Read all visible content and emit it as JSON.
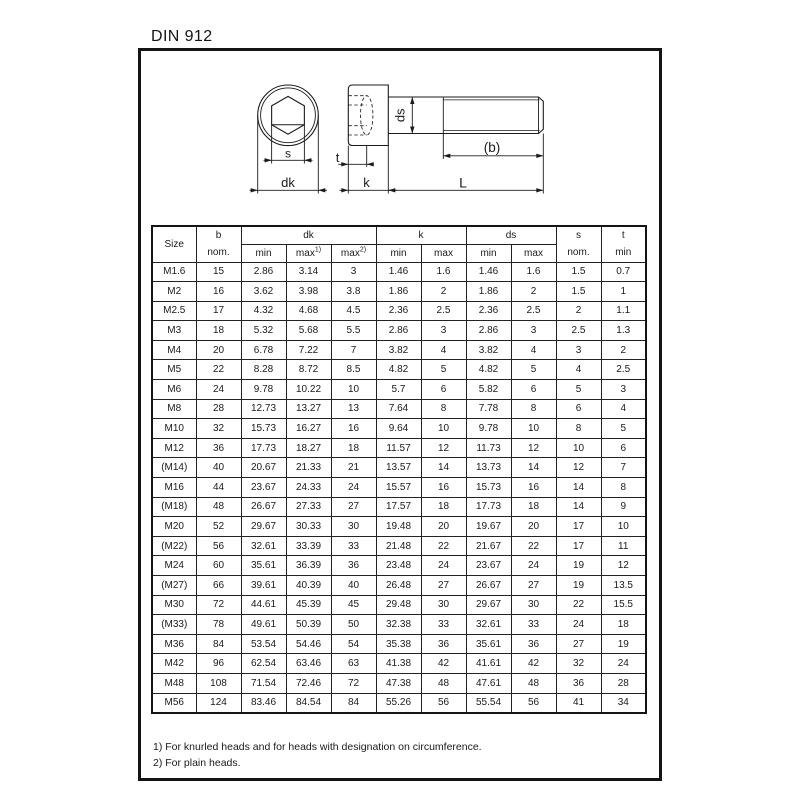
{
  "page": {
    "title": "DIN 912"
  },
  "drawing": {
    "labels": {
      "s": "s",
      "dk": "dk",
      "t": "t",
      "k": "k",
      "l": "L",
      "b": "(b)",
      "ds": "ds"
    }
  },
  "table": {
    "header": {
      "size": "Size",
      "b": "b",
      "b_sub": "nom.",
      "dk": "dk",
      "dk_min": "min",
      "dk_max1": "max",
      "dk_max1_sup": "1)",
      "dk_max2": "max",
      "dk_max2_sup": "2)",
      "k": "k",
      "k_min": "min",
      "k_max": "max",
      "ds": "ds",
      "ds_min": "min",
      "ds_max": "max",
      "s": "s",
      "s_sub": "nom.",
      "t": "t",
      "t_sub": "min"
    },
    "rows": [
      [
        "M1.6",
        "15",
        "2.86",
        "3.14",
        "3",
        "1.46",
        "1.6",
        "1.46",
        "1.6",
        "1.5",
        "0.7"
      ],
      [
        "M2",
        "16",
        "3.62",
        "3.98",
        "3.8",
        "1.86",
        "2",
        "1.86",
        "2",
        "1.5",
        "1"
      ],
      [
        "M2.5",
        "17",
        "4.32",
        "4.68",
        "4.5",
        "2.36",
        "2.5",
        "2.36",
        "2.5",
        "2",
        "1.1"
      ],
      [
        "M3",
        "18",
        "5.32",
        "5.68",
        "5.5",
        "2.86",
        "3",
        "2.86",
        "3",
        "2.5",
        "1.3"
      ],
      [
        "M4",
        "20",
        "6.78",
        "7.22",
        "7",
        "3.82",
        "4",
        "3.82",
        "4",
        "3",
        "2"
      ],
      [
        "M5",
        "22",
        "8.28",
        "8.72",
        "8.5",
        "4.82",
        "5",
        "4.82",
        "5",
        "4",
        "2.5"
      ],
      [
        "M6",
        "24",
        "9.78",
        "10.22",
        "10",
        "5.7",
        "6",
        "5.82",
        "6",
        "5",
        "3"
      ],
      [
        "M8",
        "28",
        "12.73",
        "13.27",
        "13",
        "7.64",
        "8",
        "7.78",
        "8",
        "6",
        "4"
      ],
      [
        "M10",
        "32",
        "15.73",
        "16.27",
        "16",
        "9.64",
        "10",
        "9.78",
        "10",
        "8",
        "5"
      ],
      [
        "M12",
        "36",
        "17.73",
        "18.27",
        "18",
        "11.57",
        "12",
        "11.73",
        "12",
        "10",
        "6"
      ],
      [
        "(M14)",
        "40",
        "20.67",
        "21.33",
        "21",
        "13.57",
        "14",
        "13.73",
        "14",
        "12",
        "7"
      ],
      [
        "M16",
        "44",
        "23.67",
        "24.33",
        "24",
        "15.57",
        "16",
        "15.73",
        "16",
        "14",
        "8"
      ],
      [
        "(M18)",
        "48",
        "26.67",
        "27.33",
        "27",
        "17.57",
        "18",
        "17.73",
        "18",
        "14",
        "9"
      ],
      [
        "M20",
        "52",
        "29.67",
        "30.33",
        "30",
        "19.48",
        "20",
        "19.67",
        "20",
        "17",
        "10"
      ],
      [
        "(M22)",
        "56",
        "32.61",
        "33.39",
        "33",
        "21.48",
        "22",
        "21.67",
        "22",
        "17",
        "11"
      ],
      [
        "M24",
        "60",
        "35.61",
        "36.39",
        "36",
        "23.48",
        "24",
        "23.67",
        "24",
        "19",
        "12"
      ],
      [
        "(M27)",
        "66",
        "39.61",
        "40.39",
        "40",
        "26.48",
        "27",
        "26.67",
        "27",
        "19",
        "13.5"
      ],
      [
        "M30",
        "72",
        "44.61",
        "45.39",
        "45",
        "29.48",
        "30",
        "29.67",
        "30",
        "22",
        "15.5"
      ],
      [
        "(M33)",
        "78",
        "49.61",
        "50.39",
        "50",
        "32.38",
        "33",
        "32.61",
        "33",
        "24",
        "18"
      ],
      [
        "M36",
        "84",
        "53.54",
        "54.46",
        "54",
        "35.38",
        "36",
        "35.61",
        "36",
        "27",
        "19"
      ],
      [
        "M42",
        "96",
        "62.54",
        "63.46",
        "63",
        "41.38",
        "42",
        "41.61",
        "42",
        "32",
        "24"
      ],
      [
        "M48",
        "108",
        "71.54",
        "72.46",
        "72",
        "47.38",
        "48",
        "47.61",
        "48",
        "36",
        "28"
      ],
      [
        "M56",
        "124",
        "83.46",
        "84.54",
        "84",
        "55.26",
        "56",
        "55.54",
        "56",
        "41",
        "34"
      ]
    ]
  },
  "footnotes": {
    "note1": "1) For knurled heads and for heads with designation on circumference.",
    "note2": "2) For plain heads."
  }
}
